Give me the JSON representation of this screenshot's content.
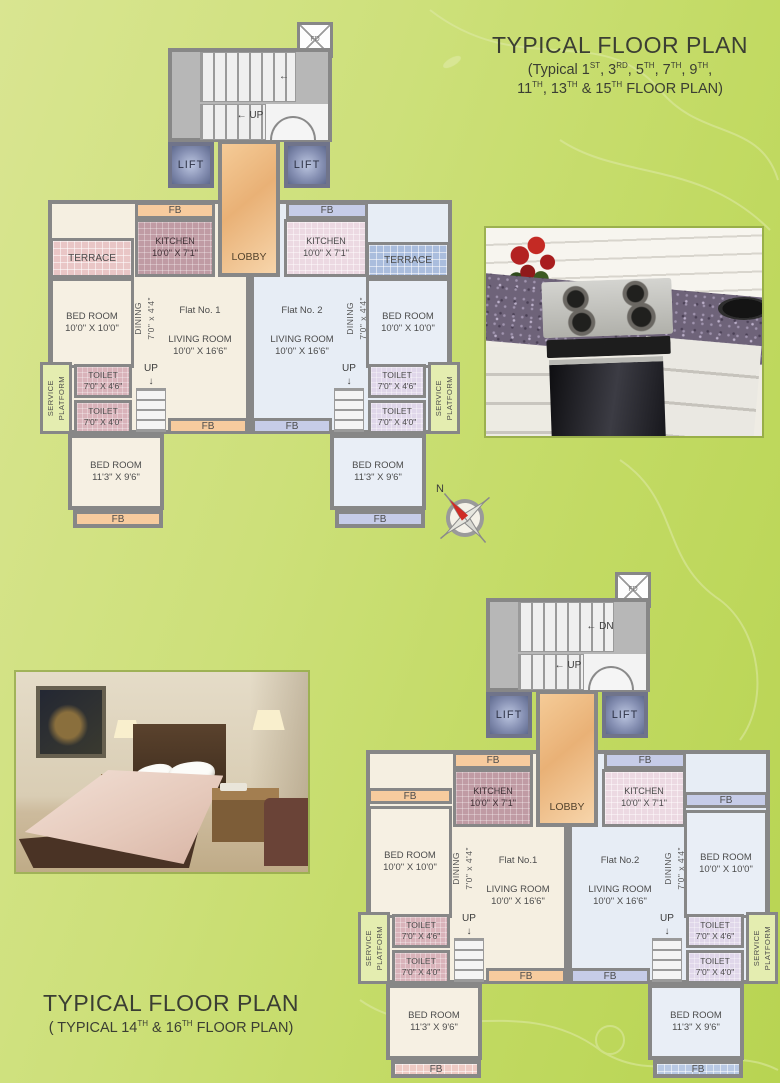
{
  "titles": {
    "upper": {
      "line1": "TYPICAL FLOOR PLAN",
      "line2": "(Typical 1ST, 3RD, 5TH, 7TH, 9TH,",
      "line3": "11TH, 13TH & 15TH FLOOR PLAN)"
    },
    "lower": {
      "line1": "TYPICAL FLOOR PLAN",
      "line2": "( TYPICAL 14TH & 16TH FLOOR PLAN)"
    }
  },
  "compass": {
    "north": "N"
  },
  "colors": {
    "page_green": "#cde07a",
    "wall_gray": "#878787",
    "lobby_tan": "#f0c28c",
    "fb_orange": "#f7cb9e",
    "fb_blue": "#c6cce8",
    "flat1_floor": "#f5efe1",
    "flat2_floor": "#e7edf5"
  },
  "plans": [
    {
      "name": "typical-floor-plan-upper",
      "x": 30,
      "y": 20,
      "w": 430,
      "h": 512,
      "rooms": [
        {
          "name": "flat1-floor-outline",
          "cls": "floor-cream wall4",
          "x": 18,
          "y": 180,
          "w": 202,
          "h": 234
        },
        {
          "name": "flat2-floor-outline",
          "cls": "floor-blue wall4",
          "x": 220,
          "y": 180,
          "w": 202,
          "h": 234
        },
        {
          "name": "fire-duct",
          "cls": "duct",
          "x": 267,
          "y": 2,
          "w": 36,
          "h": 36,
          "label": [
            "FD"
          ]
        },
        {
          "name": "stairwell",
          "cls": "stairwell wall4",
          "x": 138,
          "y": 28,
          "w": 164,
          "h": 94
        },
        {
          "name": "stair-treads-upper",
          "cls": "treads-v",
          "x": 170,
          "y": 32,
          "w": 96,
          "h": 50
        },
        {
          "name": "stair-landing",
          "cls": "stair-white",
          "x": 236,
          "y": 84,
          "w": 62,
          "h": 36
        },
        {
          "name": "stair-treads-lower",
          "cls": "treads-v",
          "x": 170,
          "y": 84,
          "w": 66,
          "h": 36
        },
        {
          "name": "stair-arrow-upper",
          "cls": "stair-note",
          "x": 234,
          "y": 48,
          "w": 40,
          "h": 16,
          "label": [
            "←"
          ]
        },
        {
          "name": "stair-up-label",
          "cls": "stair-note",
          "x": 196,
          "y": 88,
          "w": 48,
          "h": 14,
          "label": [
            "← UP"
          ]
        },
        {
          "name": "entry-door-arc",
          "cls": "arc",
          "x": 240,
          "y": 96,
          "w": 46,
          "h": 24
        },
        {
          "name": "lift-left",
          "cls": "lift",
          "x": 138,
          "y": 122,
          "w": 46,
          "h": 46,
          "label": [
            "LIFT"
          ]
        },
        {
          "name": "lift-right",
          "cls": "lift",
          "x": 254,
          "y": 122,
          "w": 46,
          "h": 46,
          "label": [
            "LIFT"
          ]
        },
        {
          "name": "lobby",
          "cls": "lobby wall4",
          "x": 188,
          "y": 120,
          "w": 62,
          "h": 137,
          "label": [
            "LOBBY"
          ]
        },
        {
          "name": "flower-bed-kitchen-1",
          "cls": "fb-orange",
          "x": 105,
          "y": 182,
          "w": 80,
          "h": 17,
          "label": [
            "FB"
          ]
        },
        {
          "name": "flower-bed-kitchen-2",
          "cls": "fb-blue",
          "x": 256,
          "y": 182,
          "w": 82,
          "h": 17,
          "label": [
            "FB"
          ]
        },
        {
          "name": "kitchen-flat1",
          "cls": "kitchen-dark",
          "x": 105,
          "y": 199,
          "w": 80,
          "h": 58,
          "label": [
            "KITCHEN",
            "10'0\" X 7'1\""
          ]
        },
        {
          "name": "kitchen-flat2",
          "cls": "kitchen-light",
          "x": 254,
          "y": 199,
          "w": 84,
          "h": 58,
          "label": [
            "KITCHEN",
            "10'0\" X 7'1\""
          ]
        },
        {
          "name": "terrace-flat1",
          "cls": "terrace-pink",
          "x": 20,
          "y": 218,
          "w": 84,
          "h": 40,
          "label": [
            "TERRACE"
          ]
        },
        {
          "name": "terrace-flat2",
          "cls": "terrace-blue",
          "x": 336,
          "y": 222,
          "w": 84,
          "h": 36,
          "label": [
            "TERRACE"
          ]
        },
        {
          "name": "bedroom-flat1-front",
          "cls": "room-cream",
          "x": 20,
          "y": 258,
          "w": 84,
          "h": 90,
          "label": [
            "BED ROOM",
            "10'0\" X 10'0\""
          ]
        },
        {
          "name": "bedroom-flat2-front",
          "cls": "room-blue",
          "x": 336,
          "y": 258,
          "w": 84,
          "h": 90,
          "label": [
            "BED ROOM",
            "10'0\" X 10'0\""
          ]
        },
        {
          "name": "dining-flat1",
          "cls": "dining rot",
          "x": 102,
          "y": 264,
          "w": 26,
          "h": 68,
          "label": [
            "DINING",
            "7'0\" x 4'4\""
          ]
        },
        {
          "name": "dining-flat2",
          "cls": "dining rot",
          "x": 314,
          "y": 264,
          "w": 26,
          "h": 68,
          "label": [
            "DINING",
            "7'0\" x 4'4\""
          ]
        },
        {
          "name": "living-room-flat1",
          "cls": "living",
          "x": 120,
          "y": 262,
          "w": 100,
          "h": 100,
          "label": [
            "Flat No. 1",
            "LIVING ROOM",
            "10'0\" X 16'6\""
          ]
        },
        {
          "name": "living-room-flat2",
          "cls": "living",
          "x": 222,
          "y": 262,
          "w": 100,
          "h": 100,
          "label": [
            "Flat No. 2",
            "LIVING ROOM",
            "10'0\" X 16'6\""
          ]
        },
        {
          "name": "service-platform-flat1",
          "cls": "service rot",
          "x": 10,
          "y": 342,
          "w": 32,
          "h": 72,
          "label": [
            "SERVICE",
            "PLATFORM"
          ]
        },
        {
          "name": "toilet-flat1-a",
          "cls": "toilet-pink",
          "x": 44,
          "y": 344,
          "w": 58,
          "h": 34,
          "label": [
            "TOILET",
            "7'0\" X 4'6\""
          ]
        },
        {
          "name": "toilet-flat1-b",
          "cls": "toilet-pink",
          "x": 44,
          "y": 380,
          "w": 58,
          "h": 34,
          "label": [
            "TOILET",
            "7'0\" X 4'0\""
          ]
        },
        {
          "name": "internal-stair-label-flat1",
          "cls": "stair-note",
          "x": 104,
          "y": 344,
          "w": 34,
          "h": 22,
          "label": [
            "UP",
            "↓"
          ]
        },
        {
          "name": "internal-stair-flat1",
          "cls": "treads-h",
          "x": 106,
          "y": 368,
          "w": 30,
          "h": 44
        },
        {
          "name": "flower-bed-mid-1",
          "cls": "fb-orange",
          "x": 138,
          "y": 398,
          "w": 80,
          "h": 16,
          "label": [
            "FB"
          ]
        },
        {
          "name": "toilet-flat2-a",
          "cls": "toilet-lav",
          "x": 338,
          "y": 344,
          "w": 58,
          "h": 34,
          "label": [
            "TOILET",
            "7'0\" X 4'6\""
          ]
        },
        {
          "name": "toilet-flat2-b",
          "cls": "toilet-lav",
          "x": 338,
          "y": 380,
          "w": 58,
          "h": 34,
          "label": [
            "TOILET",
            "7'0\" X 4'0\""
          ]
        },
        {
          "name": "service-platform-flat2",
          "cls": "service rot",
          "x": 398,
          "y": 342,
          "w": 32,
          "h": 72,
          "label": [
            "SERVICE",
            "PLATFORM"
          ]
        },
        {
          "name": "internal-stair-label-flat2",
          "cls": "stair-note",
          "x": 302,
          "y": 344,
          "w": 34,
          "h": 22,
          "label": [
            "UP",
            "↓"
          ]
        },
        {
          "name": "internal-stair-flat2",
          "cls": "treads-h",
          "x": 304,
          "y": 368,
          "w": 30,
          "h": 44
        },
        {
          "name": "flower-bed-mid-2",
          "cls": "fb-blue",
          "x": 222,
          "y": 398,
          "w": 80,
          "h": 16,
          "label": [
            "FB"
          ]
        },
        {
          "name": "bedroom-flat1-rear",
          "cls": "room-cream wall4",
          "x": 38,
          "y": 414,
          "w": 96,
          "h": 76,
          "label": [
            "BED ROOM",
            "11'3\" X 9'6\""
          ]
        },
        {
          "name": "flower-bed-bottom-1",
          "cls": "fb-orange wall4",
          "x": 43,
          "y": 490,
          "w": 90,
          "h": 18,
          "label": [
            "FB"
          ]
        },
        {
          "name": "bedroom-flat2-rear",
          "cls": "room-blue wall4",
          "x": 300,
          "y": 414,
          "w": 96,
          "h": 76,
          "label": [
            "BED ROOM",
            "11'3\" X 9'6\""
          ]
        },
        {
          "name": "flower-bed-bottom-2",
          "cls": "fb-blue wall4",
          "x": 305,
          "y": 490,
          "w": 90,
          "h": 18,
          "label": [
            "FB"
          ]
        }
      ]
    },
    {
      "name": "typical-floor-plan-lower",
      "x": 348,
      "y": 570,
      "w": 430,
      "h": 512,
      "rooms": [
        {
          "name": "flat1-floor-outline",
          "cls": "floor-cream wall4",
          "x": 18,
          "y": 180,
          "w": 202,
          "h": 234
        },
        {
          "name": "flat2-floor-outline",
          "cls": "floor-blue wall4",
          "x": 220,
          "y": 180,
          "w": 202,
          "h": 234
        },
        {
          "name": "fire-duct",
          "cls": "duct",
          "x": 267,
          "y": 2,
          "w": 36,
          "h": 36,
          "label": [
            "FD"
          ]
        },
        {
          "name": "stairwell",
          "cls": "stairwell wall4",
          "x": 138,
          "y": 28,
          "w": 164,
          "h": 94
        },
        {
          "name": "stair-treads-upper",
          "cls": "treads-v",
          "x": 170,
          "y": 32,
          "w": 96,
          "h": 50
        },
        {
          "name": "stair-landing",
          "cls": "stair-white",
          "x": 236,
          "y": 84,
          "w": 62,
          "h": 36
        },
        {
          "name": "stair-treads-lower",
          "cls": "treads-v",
          "x": 170,
          "y": 84,
          "w": 66,
          "h": 36
        },
        {
          "name": "stair-dn-label",
          "cls": "stair-note",
          "x": 226,
          "y": 48,
          "w": 52,
          "h": 16,
          "label": [
            "← DN"
          ]
        },
        {
          "name": "stair-up-label",
          "cls": "stair-note",
          "x": 196,
          "y": 88,
          "w": 48,
          "h": 14,
          "label": [
            "← UP"
          ]
        },
        {
          "name": "entry-door-arc",
          "cls": "arc",
          "x": 240,
          "y": 96,
          "w": 46,
          "h": 24
        },
        {
          "name": "lift-left",
          "cls": "lift",
          "x": 138,
          "y": 122,
          "w": 46,
          "h": 46,
          "label": [
            "LIFT"
          ]
        },
        {
          "name": "lift-right",
          "cls": "lift",
          "x": 254,
          "y": 122,
          "w": 46,
          "h": 46,
          "label": [
            "LIFT"
          ]
        },
        {
          "name": "lobby",
          "cls": "lobby wall4",
          "x": 188,
          "y": 120,
          "w": 62,
          "h": 137,
          "label": [
            "LOBBY"
          ]
        },
        {
          "name": "flower-bed-kitchen-1",
          "cls": "fb-orange",
          "x": 105,
          "y": 182,
          "w": 80,
          "h": 17,
          "label": [
            "FB"
          ]
        },
        {
          "name": "flower-bed-kitchen-2",
          "cls": "fb-blue",
          "x": 256,
          "y": 182,
          "w": 82,
          "h": 17,
          "label": [
            "FB"
          ]
        },
        {
          "name": "kitchen-flat1",
          "cls": "kitchen-dark",
          "x": 105,
          "y": 199,
          "w": 80,
          "h": 58,
          "label": [
            "KITCHEN",
            "10'0\" X 7'1\""
          ]
        },
        {
          "name": "kitchen-flat2",
          "cls": "kitchen-light",
          "x": 254,
          "y": 199,
          "w": 84,
          "h": 58,
          "label": [
            "KITCHEN",
            "10'0\" X 7'1\""
          ]
        },
        {
          "name": "flower-bed-bedroom-1",
          "cls": "fb-orange",
          "x": 20,
          "y": 218,
          "w": 84,
          "h": 16,
          "label": [
            "FB"
          ]
        },
        {
          "name": "flower-bed-bedroom-2",
          "cls": "fb-blue",
          "x": 336,
          "y": 222,
          "w": 84,
          "h": 16,
          "label": [
            "FB"
          ]
        },
        {
          "name": "bedroom-flat1-front",
          "cls": "room-cream",
          "x": 20,
          "y": 236,
          "w": 84,
          "h": 112,
          "label": [
            "BED ROOM",
            "10'0\" X 10'0\""
          ]
        },
        {
          "name": "bedroom-flat2-front",
          "cls": "room-blue",
          "x": 336,
          "y": 240,
          "w": 84,
          "h": 108,
          "label": [
            "BED ROOM",
            "10'0\" X 10'0\""
          ]
        },
        {
          "name": "dining-flat1",
          "cls": "dining rot",
          "x": 102,
          "y": 264,
          "w": 26,
          "h": 68,
          "label": [
            "DINING",
            "7'0\" x 4'4\""
          ]
        },
        {
          "name": "dining-flat2",
          "cls": "dining rot",
          "x": 314,
          "y": 264,
          "w": 26,
          "h": 68,
          "label": [
            "DINING",
            "7'0\" x 4'4\""
          ]
        },
        {
          "name": "living-room-flat1",
          "cls": "living",
          "x": 120,
          "y": 262,
          "w": 100,
          "h": 100,
          "label": [
            "Flat No.1",
            "LIVING ROOM",
            "10'0\" X 16'6\""
          ]
        },
        {
          "name": "living-room-flat2",
          "cls": "living",
          "x": 222,
          "y": 262,
          "w": 100,
          "h": 100,
          "label": [
            "Flat No.2",
            "LIVING ROOM",
            "10'0\" X 16'6\""
          ]
        },
        {
          "name": "service-platform-flat1",
          "cls": "service rot",
          "x": 10,
          "y": 342,
          "w": 32,
          "h": 72,
          "label": [
            "SERVICE",
            "PLATFORM"
          ]
        },
        {
          "name": "toilet-flat1-a",
          "cls": "toilet-pink",
          "x": 44,
          "y": 344,
          "w": 58,
          "h": 34,
          "label": [
            "TOILET",
            "7'0\" X 4'6\""
          ]
        },
        {
          "name": "toilet-flat1-b",
          "cls": "toilet-pink",
          "x": 44,
          "y": 380,
          "w": 58,
          "h": 34,
          "label": [
            "TOILET",
            "7'0\" X 4'0\""
          ]
        },
        {
          "name": "internal-stair-label-flat1",
          "cls": "stair-note",
          "x": 104,
          "y": 344,
          "w": 34,
          "h": 22,
          "label": [
            "UP",
            "↓"
          ]
        },
        {
          "name": "internal-stair-flat1",
          "cls": "treads-h",
          "x": 106,
          "y": 368,
          "w": 30,
          "h": 44
        },
        {
          "name": "flower-bed-mid-1",
          "cls": "fb-orange",
          "x": 138,
          "y": 398,
          "w": 80,
          "h": 16,
          "label": [
            "FB"
          ]
        },
        {
          "name": "toilet-flat2-a",
          "cls": "toilet-lav",
          "x": 338,
          "y": 344,
          "w": 58,
          "h": 34,
          "label": [
            "TOILET",
            "7'0\" X 4'6\""
          ]
        },
        {
          "name": "toilet-flat2-b",
          "cls": "toilet-lav",
          "x": 338,
          "y": 380,
          "w": 58,
          "h": 34,
          "label": [
            "TOILET",
            "7'0\" X 4'0\""
          ]
        },
        {
          "name": "service-platform-flat2",
          "cls": "service rot",
          "x": 398,
          "y": 342,
          "w": 32,
          "h": 72,
          "label": [
            "SERVICE",
            "PLATFORM"
          ]
        },
        {
          "name": "internal-stair-label-flat2",
          "cls": "stair-note",
          "x": 302,
          "y": 344,
          "w": 34,
          "h": 22,
          "label": [
            "UP",
            "↓"
          ]
        },
        {
          "name": "internal-stair-flat2",
          "cls": "treads-h",
          "x": 304,
          "y": 368,
          "w": 30,
          "h": 44
        },
        {
          "name": "flower-bed-mid-2",
          "cls": "fb-blue",
          "x": 222,
          "y": 398,
          "w": 80,
          "h": 16,
          "label": [
            "FB"
          ]
        },
        {
          "name": "bedroom-flat1-rear",
          "cls": "room-cream wall4",
          "x": 38,
          "y": 414,
          "w": 96,
          "h": 76,
          "label": [
            "BED ROOM",
            "11'3\" X 9'6\""
          ]
        },
        {
          "name": "flower-bed-bottom-1",
          "cls": "fb-mosaic-pink wall4",
          "x": 43,
          "y": 490,
          "w": 90,
          "h": 18,
          "label": [
            "FB"
          ]
        },
        {
          "name": "bedroom-flat2-rear",
          "cls": "room-blue wall4",
          "x": 300,
          "y": 414,
          "w": 96,
          "h": 76,
          "label": [
            "BED ROOM",
            "11'3\" X 9'6\""
          ]
        },
        {
          "name": "flower-bed-bottom-2",
          "cls": "fb-mosaic-blue wall4",
          "x": 305,
          "y": 490,
          "w": 90,
          "h": 18,
          "label": [
            "FB"
          ]
        }
      ]
    }
  ]
}
